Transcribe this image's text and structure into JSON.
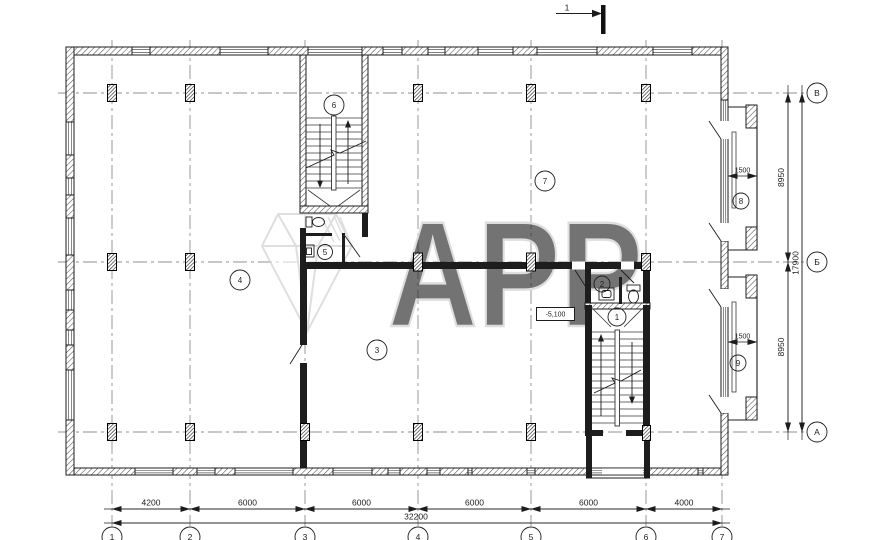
{
  "drawing": {
    "type": "architectural-floor-plan",
    "watermark": "APP",
    "section_marker": "1",
    "elevation": "-5,100",
    "rooms": [
      "1",
      "2",
      "3",
      "4",
      "5",
      "6",
      "7",
      "8",
      "9"
    ],
    "axes_bottom": [
      "1",
      "2",
      "3",
      "4",
      "5",
      "6",
      "7"
    ],
    "axes_right": [
      "В",
      "Б",
      "А"
    ],
    "dims_bottom": [
      "4200",
      "6000",
      "6000",
      "6000",
      "6000",
      "4000"
    ],
    "dim_bottom_total": "32200",
    "dims_right": [
      "8950",
      "8950"
    ],
    "dim_right_total": "17900",
    "dim_balcony_upper": "1500",
    "dim_balcony_lower": "1500",
    "colors": {
      "ink": "#1d1d1d",
      "grid": "#8f8f8f",
      "watermark": "#d7d7d7"
    }
  }
}
